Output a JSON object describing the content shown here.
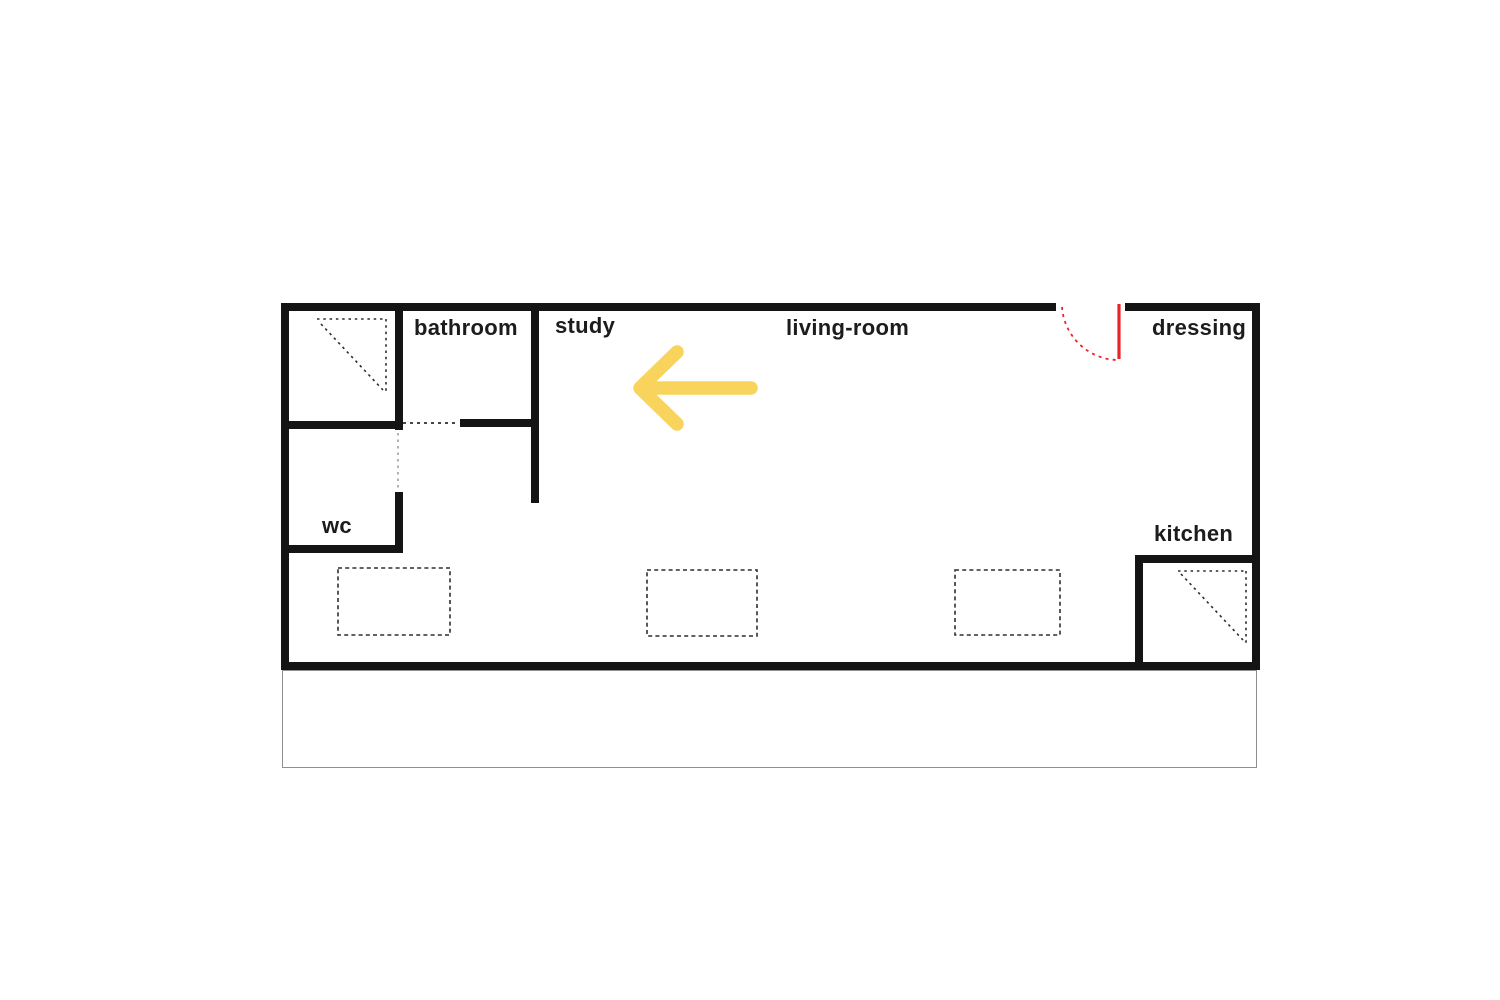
{
  "floor_plan": {
    "title": "apartment-floor-plan",
    "labels": {
      "bathroom": "bathroom",
      "study": "study",
      "living_room": "living-room",
      "dressing": "dressing",
      "wc": "wc",
      "kitchen": "kitchen"
    },
    "rooms": [
      {
        "id": "bathroom",
        "label": "bathroom"
      },
      {
        "id": "study",
        "label": "study"
      },
      {
        "id": "living-room",
        "label": "living-room"
      },
      {
        "id": "dressing",
        "label": "dressing"
      },
      {
        "id": "wc",
        "label": "wc"
      },
      {
        "id": "kitchen",
        "label": "kitchen"
      }
    ],
    "icons": {
      "arrow": "left-arrow-icon",
      "door": "door-swing-icon",
      "bathroom_corner": "shower-tray-icon",
      "kitchen_corner": "shower-tray-icon"
    },
    "colors": {
      "wall": "#141414",
      "text": "#1c1c1c",
      "arrow_yellow": "#f8d45c",
      "door_red": "#e8242a",
      "furniture_dash": "#2f2f2f",
      "light_dash": "#9e9e9e",
      "terrace_outline": "#8f8f8f",
      "background": "#ffffff"
    },
    "furniture_outline_count": 3
  }
}
